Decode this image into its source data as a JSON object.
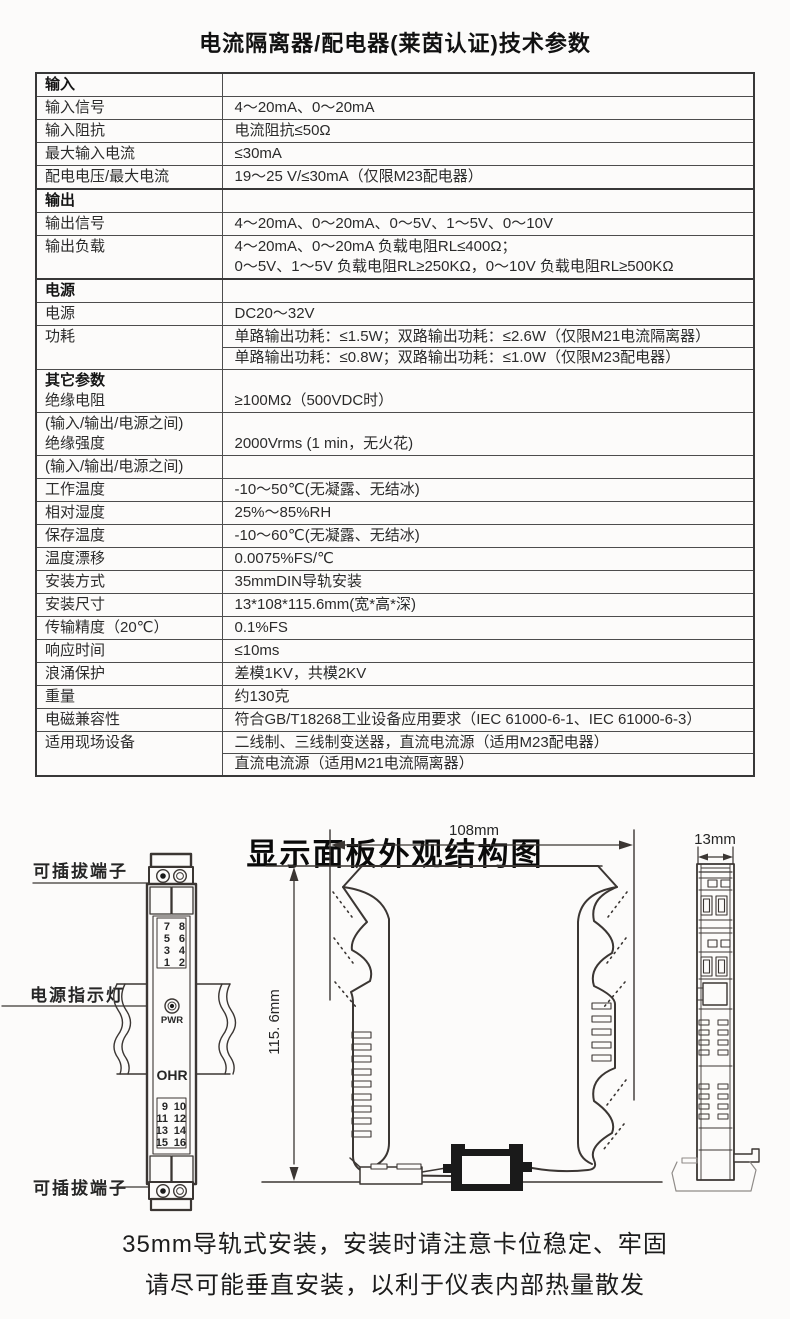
{
  "page": {
    "title": "电流隔离器/配电器(莱茵认证)技术参数",
    "diagram_title": "显示面板外观结构图",
    "footer_line1": "35mm导轨式安装，安装时请注意卡位稳定、牢固",
    "footer_line2": "请尽可能垂直安装，以利于仪表内部热量散发"
  },
  "table": {
    "rows": [
      {
        "type": "section",
        "label": "输入"
      },
      {
        "type": "simple",
        "label": "输入信号",
        "value": "4～20mA、0～20mA"
      },
      {
        "type": "simple",
        "label": "输入阻抗",
        "value": "电流阻抗≤50Ω"
      },
      {
        "type": "simple",
        "label": "最大输入电流",
        "value": "≤30mA"
      },
      {
        "type": "simple",
        "label": "配电电压/最大电流",
        "value": "19～25 V/≤30mA（仅限M23配电器）"
      },
      {
        "type": "section",
        "label": "输出"
      },
      {
        "type": "simple",
        "label": "输出信号",
        "value": "4～20mA、0～20mA、0～5V、1～5V、0～10V"
      },
      {
        "type": "multiline",
        "label": "输出负载",
        "values": [
          "4～20mA、0～20mA 负载电阻RL≤400Ω；",
          "0～5V、1～5V 负载电阻RL≥250KΩ，0～10V 负载电阻RL≥500KΩ"
        ]
      },
      {
        "type": "section",
        "label": "电源"
      },
      {
        "type": "simple",
        "label": "电源",
        "value": "DC20～32V"
      },
      {
        "type": "split",
        "label": "功耗",
        "values": [
          "单路输出功耗：≤1.5W；双路输出功耗：≤2.6W（仅限M21电流隔离器）",
          "单路输出功耗：≤0.8W；双路输出功耗：≤1.0W（仅限M23配电器）"
        ]
      },
      {
        "type": "twolabel",
        "labels": [
          {
            "text": "其它参数",
            "bold": true
          },
          {
            "text": "绝缘电阻",
            "bold": false
          }
        ],
        "value": "≥100MΩ（500VDC时）"
      },
      {
        "type": "twolabel",
        "labels": [
          {
            "text": "(输入/输出/电源之间)",
            "bold": false
          },
          {
            "text": "绝缘强度",
            "bold": false
          }
        ],
        "value": "2000Vrms (1 min，无火花)"
      },
      {
        "type": "simple",
        "label": "(输入/输出/电源之间)",
        "value": ""
      },
      {
        "type": "simple",
        "label": "工作温度",
        "value": "-10～50℃(无凝露、无结冰)"
      },
      {
        "type": "simple",
        "label": "相对湿度",
        "value": "25%～85%RH"
      },
      {
        "type": "simple",
        "label": "保存温度",
        "value": "-10～60℃(无凝露、无结冰)"
      },
      {
        "type": "simple",
        "label": "温度漂移",
        "value": "0.0075%FS/℃"
      },
      {
        "type": "simple",
        "label": "安装方式",
        "value": "35mmDIN导轨安装"
      },
      {
        "type": "simple",
        "label": "安装尺寸",
        "value": "13*108*115.6mm(宽*高*深)"
      },
      {
        "type": "simple",
        "label": "传输精度（20℃）",
        "value": "0.1%FS"
      },
      {
        "type": "simple",
        "label": "响应时间",
        "value": "≤10ms"
      },
      {
        "type": "simple",
        "label": "浪涌保护",
        "value": "差模1KV，共模2KV"
      },
      {
        "type": "simple",
        "label": "重量",
        "value": "约130克"
      },
      {
        "type": "simple",
        "label": "电磁兼容性",
        "value": "符合GB/T18268工业设备应用要求（IEC 61000-6-1、IEC 61000-6-3）"
      },
      {
        "type": "split",
        "label": "适用现场设备",
        "values": [
          "二线制、三线制变送器，直流电流源（适用M23配电器）",
          "直流电流源（适用M21电流隔离器）"
        ]
      }
    ]
  },
  "diagram": {
    "front_view": {
      "plug_label_top": "可插拔端子",
      "power_led_label": "电源指示灯",
      "plug_label_bottom": "可插拔端子",
      "led_text": "PWR",
      "brand": "OHR",
      "top_terminal_left": [
        "7",
        "5",
        "3",
        "1"
      ],
      "top_terminal_right": [
        "8",
        "6",
        "4",
        "2"
      ],
      "bottom_terminal_left": [
        "9",
        "11",
        "13",
        "15"
      ],
      "bottom_terminal_right": [
        "10",
        "12",
        "14",
        "16"
      ]
    },
    "top_view": {
      "width_dim": "108mm",
      "height_dim": "115. 6mm"
    },
    "side_view": {
      "width_dim": "13mm"
    }
  },
  "colors": {
    "background": "#fcfbfa",
    "text": "#262626",
    "table_border": "#454545",
    "line": "#3b3633",
    "rail_profile": "#8f8b88"
  }
}
